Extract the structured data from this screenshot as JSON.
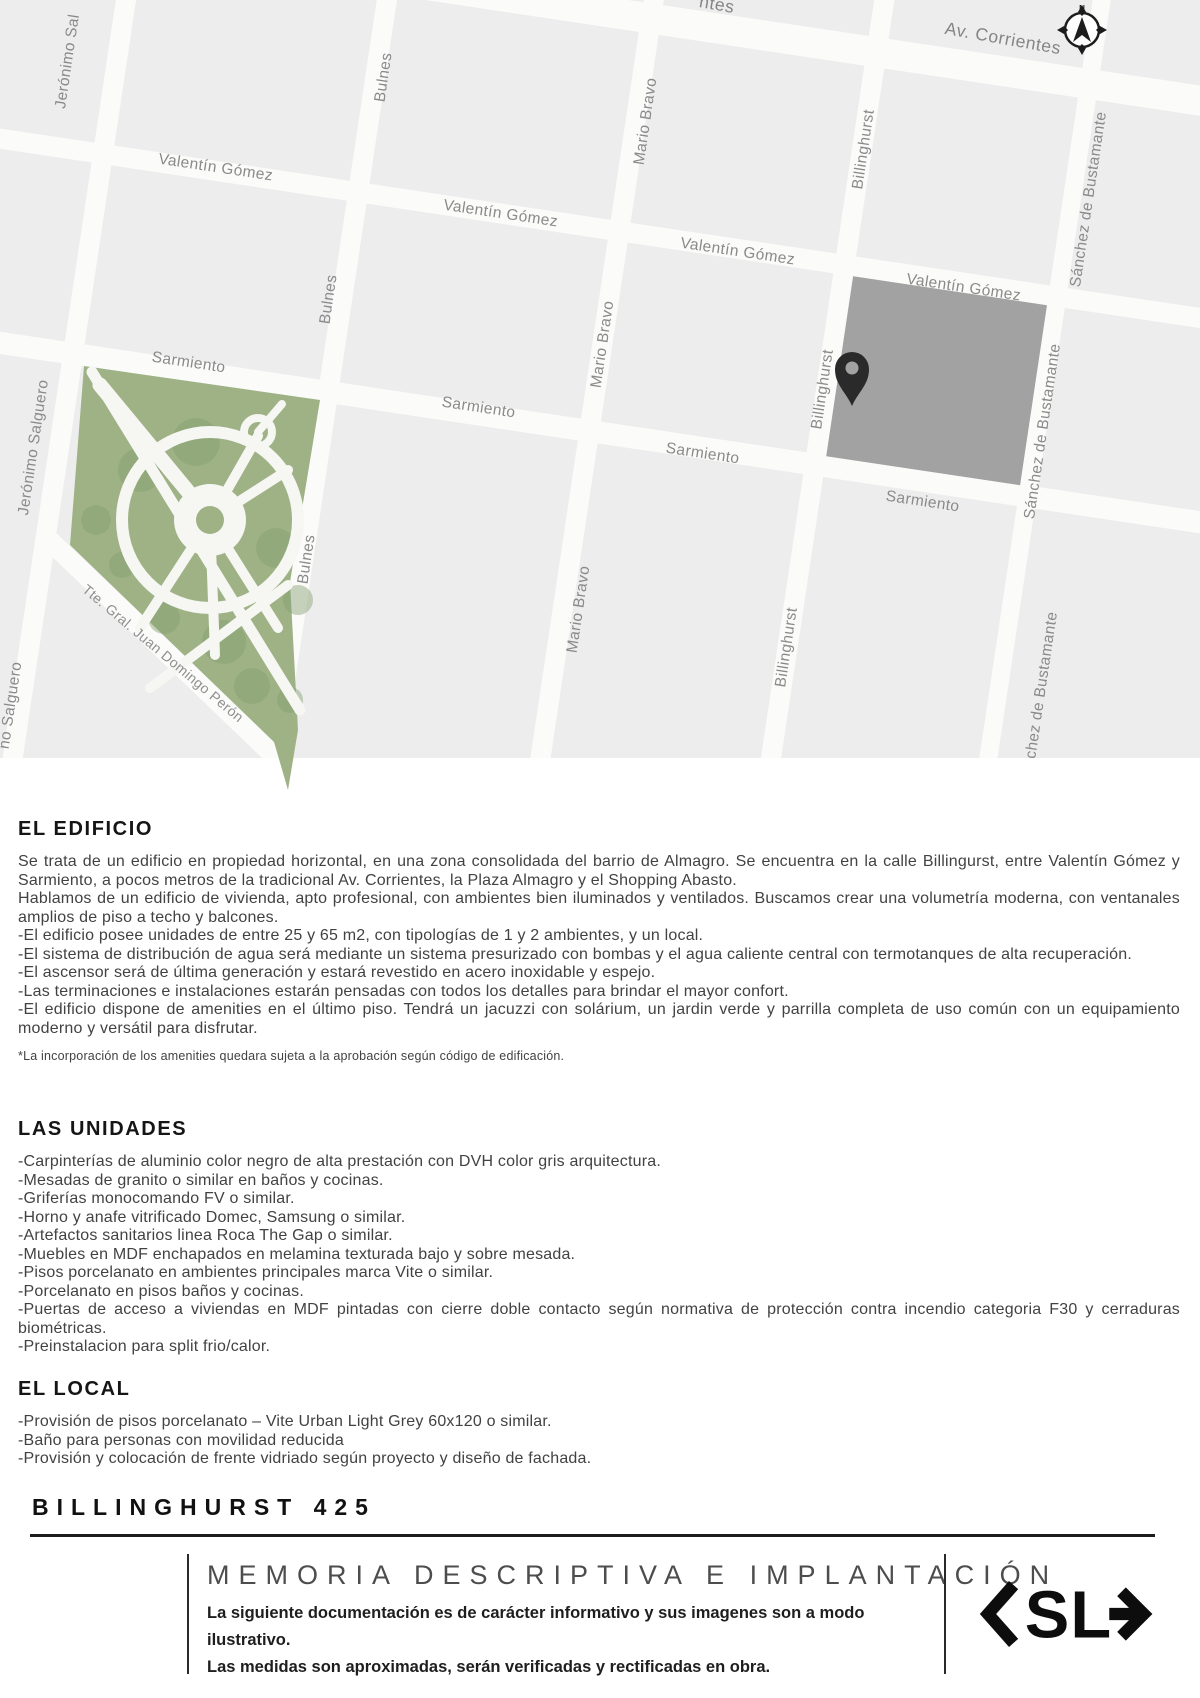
{
  "map": {
    "compass_label": "N",
    "colors": {
      "block": "#ededee",
      "street": "#fbfbfa",
      "park": "#9eb286",
      "tree": "#85a06e",
      "building": "#a2a2a3",
      "pin": "#2a2a2a",
      "label": "#8a8a8a"
    },
    "labels": [
      "Jerónimo Sal",
      "Bulnes",
      "Mario Bravo",
      "Billinghurst",
      "Sánchez de Bustamante",
      "Valentín Gómez",
      "Valentín Gómez",
      "Valentín Gómez",
      "Valentín Gómez",
      "Sarmiento",
      "Sarmiento",
      "Sarmiento",
      "Sarmiento",
      "Av. Corrientes",
      "ntes",
      "Jerónimo Salguero",
      "Bulnes",
      "Mario Bravo",
      "Billinghurst",
      "Sánchez de Bustamante",
      "Bulnes",
      "Mario Bravo",
      "Billinghurst",
      "Sánchez de Bustamante",
      "no Salguero",
      "Tte. Gral. Juan Domingo Perón"
    ]
  },
  "sections": {
    "edificio": {
      "title": "EL EDIFICIO",
      "paragraphs": [
        "Se trata de un edificio en propiedad horizontal, en una zona consolidada del barrio de Almagro. Se encuentra en la calle Billingurst, entre Valentín Gómez y Sarmiento, a pocos metros de la tradicional Av. Corrientes, la Plaza Almagro y el Shopping Abasto.",
        "Hablamos de un edificio de vivienda, apto profesional, con ambientes bien iluminados y ventilados. Buscamos crear una volumetría moderna, con ventanales amplios de piso a techo y balcones.",
        "-El edificio posee unidades de entre 25 y 65 m2, con tipologías de 1 y 2 ambientes, y un local.",
        "-El sistema de distribución de agua será mediante un sistema presurizado con bombas y el agua caliente central con termotanques de alta recuperación.",
        "-El ascensor será de última generación y estará revestido en acero inoxidable y espejo.",
        "-Las terminaciones e instalaciones estarán pensadas con todos los detalles para brindar el mayor confort.",
        "-El edificio dispone de amenities en el último piso. Tendrá un jacuzzi con solárium, un jardin verde y parrilla completa de uso común con un equipamiento moderno y versátil para disfrutar."
      ],
      "footnote": "*La incorporación de los amenities quedara sujeta a la aprobación según código de edificación."
    },
    "unidades": {
      "title": "LAS UNIDADES",
      "items": [
        "-Carpinterías de aluminio color negro de alta prestación con DVH color gris arquitectura.",
        "-Mesadas de granito o similar en baños y cocinas.",
        "-Griferías monocomando FV o similar.",
        "-Horno y anafe vitrificado Domec, Samsung o similar.",
        "-Artefactos sanitarios linea Roca The Gap o similar.",
        "-Muebles en MDF enchapados en melamina texturada bajo y sobre mesada.",
        "-Pisos porcelanato en ambientes principales marca Vite o similar.",
        "-Porcelanato en pisos baños y cocinas.",
        "-Puertas de acceso a viviendas en MDF pintadas con cierre doble contacto según normativa de protección contra incendio categoria F30 y cerraduras biométricas.",
        "-Preinstalacion para split frio/calor."
      ]
    },
    "local": {
      "title": "EL LOCAL",
      "items": [
        "-Provisión de pisos porcelanato – Vite Urban Light Grey 60x120 o similar.",
        "-Baño para personas con movilidad reducida",
        "-Provisión y colocación de frente vidriado según proyecto y diseño de fachada."
      ]
    }
  },
  "footer": {
    "project_title": "BILLINGHURST 425",
    "doc_title": "MEMORIA DESCRIPTIVA E IMPLANTACIÓN",
    "note_line1": "La siguiente documentación es de carácter informativo y sus imagenes son a modo ilustrativo.",
    "note_line2": "Las medidas son aproximadas, serán verificadas  y rectificadas en obra.",
    "logo_text": "SL"
  }
}
